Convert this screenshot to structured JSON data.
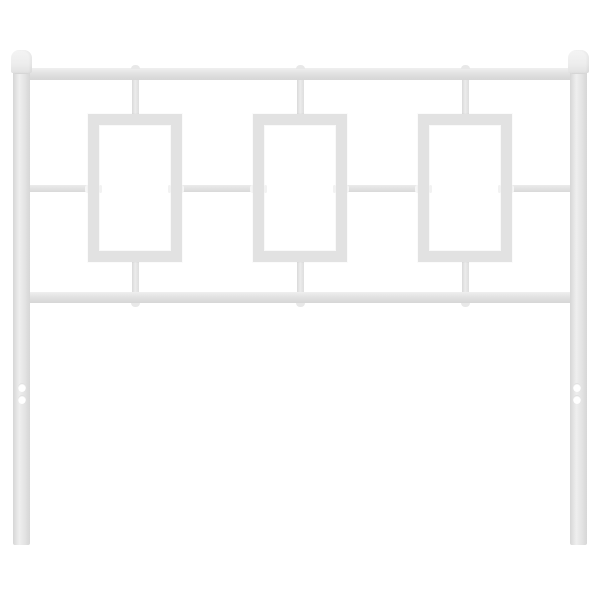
{
  "meta": {
    "type": "product-photo",
    "subject": "white metal bed headboard",
    "backdrop": "plain white studio background"
  },
  "colors": {
    "background": "#ffffff",
    "metal": "#e2e2e2",
    "metal_light": "#efefef",
    "metal_dark": "#d6d6d6",
    "finial": "#f4f4f4",
    "weld_highlight": "#f6f6f6",
    "hole": "#ffffff"
  },
  "parts": {
    "left_post": "left post with finial cap and two bolt holes",
    "right_post": "right post with finial cap and two bolt holes",
    "top_rail": "top horizontal rail",
    "mid_crossbar": "middle horizontal crossbar",
    "bottom_rail": "lower horizontal rail",
    "panels": [
      "left rectangular panel",
      "center rectangular panel",
      "right rectangular panel"
    ]
  }
}
